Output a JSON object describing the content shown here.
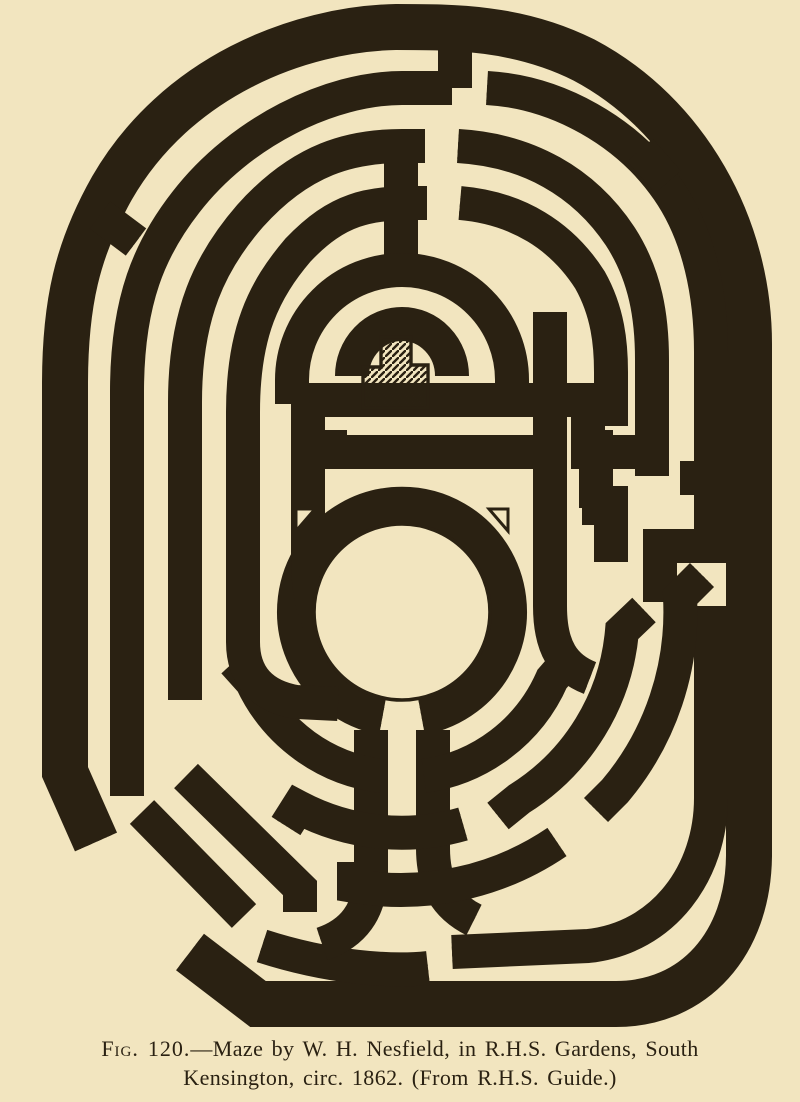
{
  "figure": {
    "caption_fig_label": "Fig. 120.",
    "caption_line1_rest": "—Maze by W. H. Nesfield, in R.H.S. Gardens, South",
    "caption_line2": "Kensington, circ. 1862.  (From R.H.S. Guide.)"
  },
  "colors": {
    "paper": "#f2e5bf",
    "ink": "#2a2112"
  }
}
